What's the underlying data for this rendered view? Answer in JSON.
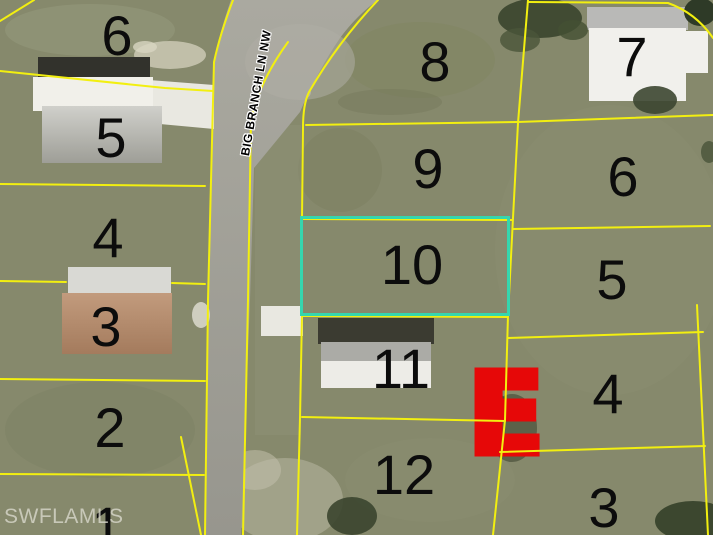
{
  "map": {
    "street_label": "BIG BRANCH LN NW",
    "watermark": "SWFLAMLS",
    "marker_letter": "E",
    "highlighted_lot": "10",
    "colors": {
      "highlight": "#35d6ae",
      "lot_line": "#f2ef10",
      "marker": "#e60808"
    },
    "lots": [
      {
        "label": "6",
        "column": "west"
      },
      {
        "label": "5",
        "column": "west"
      },
      {
        "label": "4",
        "column": "west"
      },
      {
        "label": "3",
        "column": "west"
      },
      {
        "label": "2",
        "column": "west"
      },
      {
        "label": "1",
        "column": "west"
      },
      {
        "label": "8",
        "column": "middle"
      },
      {
        "label": "9",
        "column": "middle"
      },
      {
        "label": "10",
        "column": "middle"
      },
      {
        "label": "11",
        "column": "middle"
      },
      {
        "label": "12",
        "column": "middle"
      },
      {
        "label": "7",
        "column": "east"
      },
      {
        "label": "6",
        "column": "east"
      },
      {
        "label": "5",
        "column": "east"
      },
      {
        "label": "4",
        "column": "east"
      },
      {
        "label": "3",
        "column": "east"
      }
    ]
  }
}
